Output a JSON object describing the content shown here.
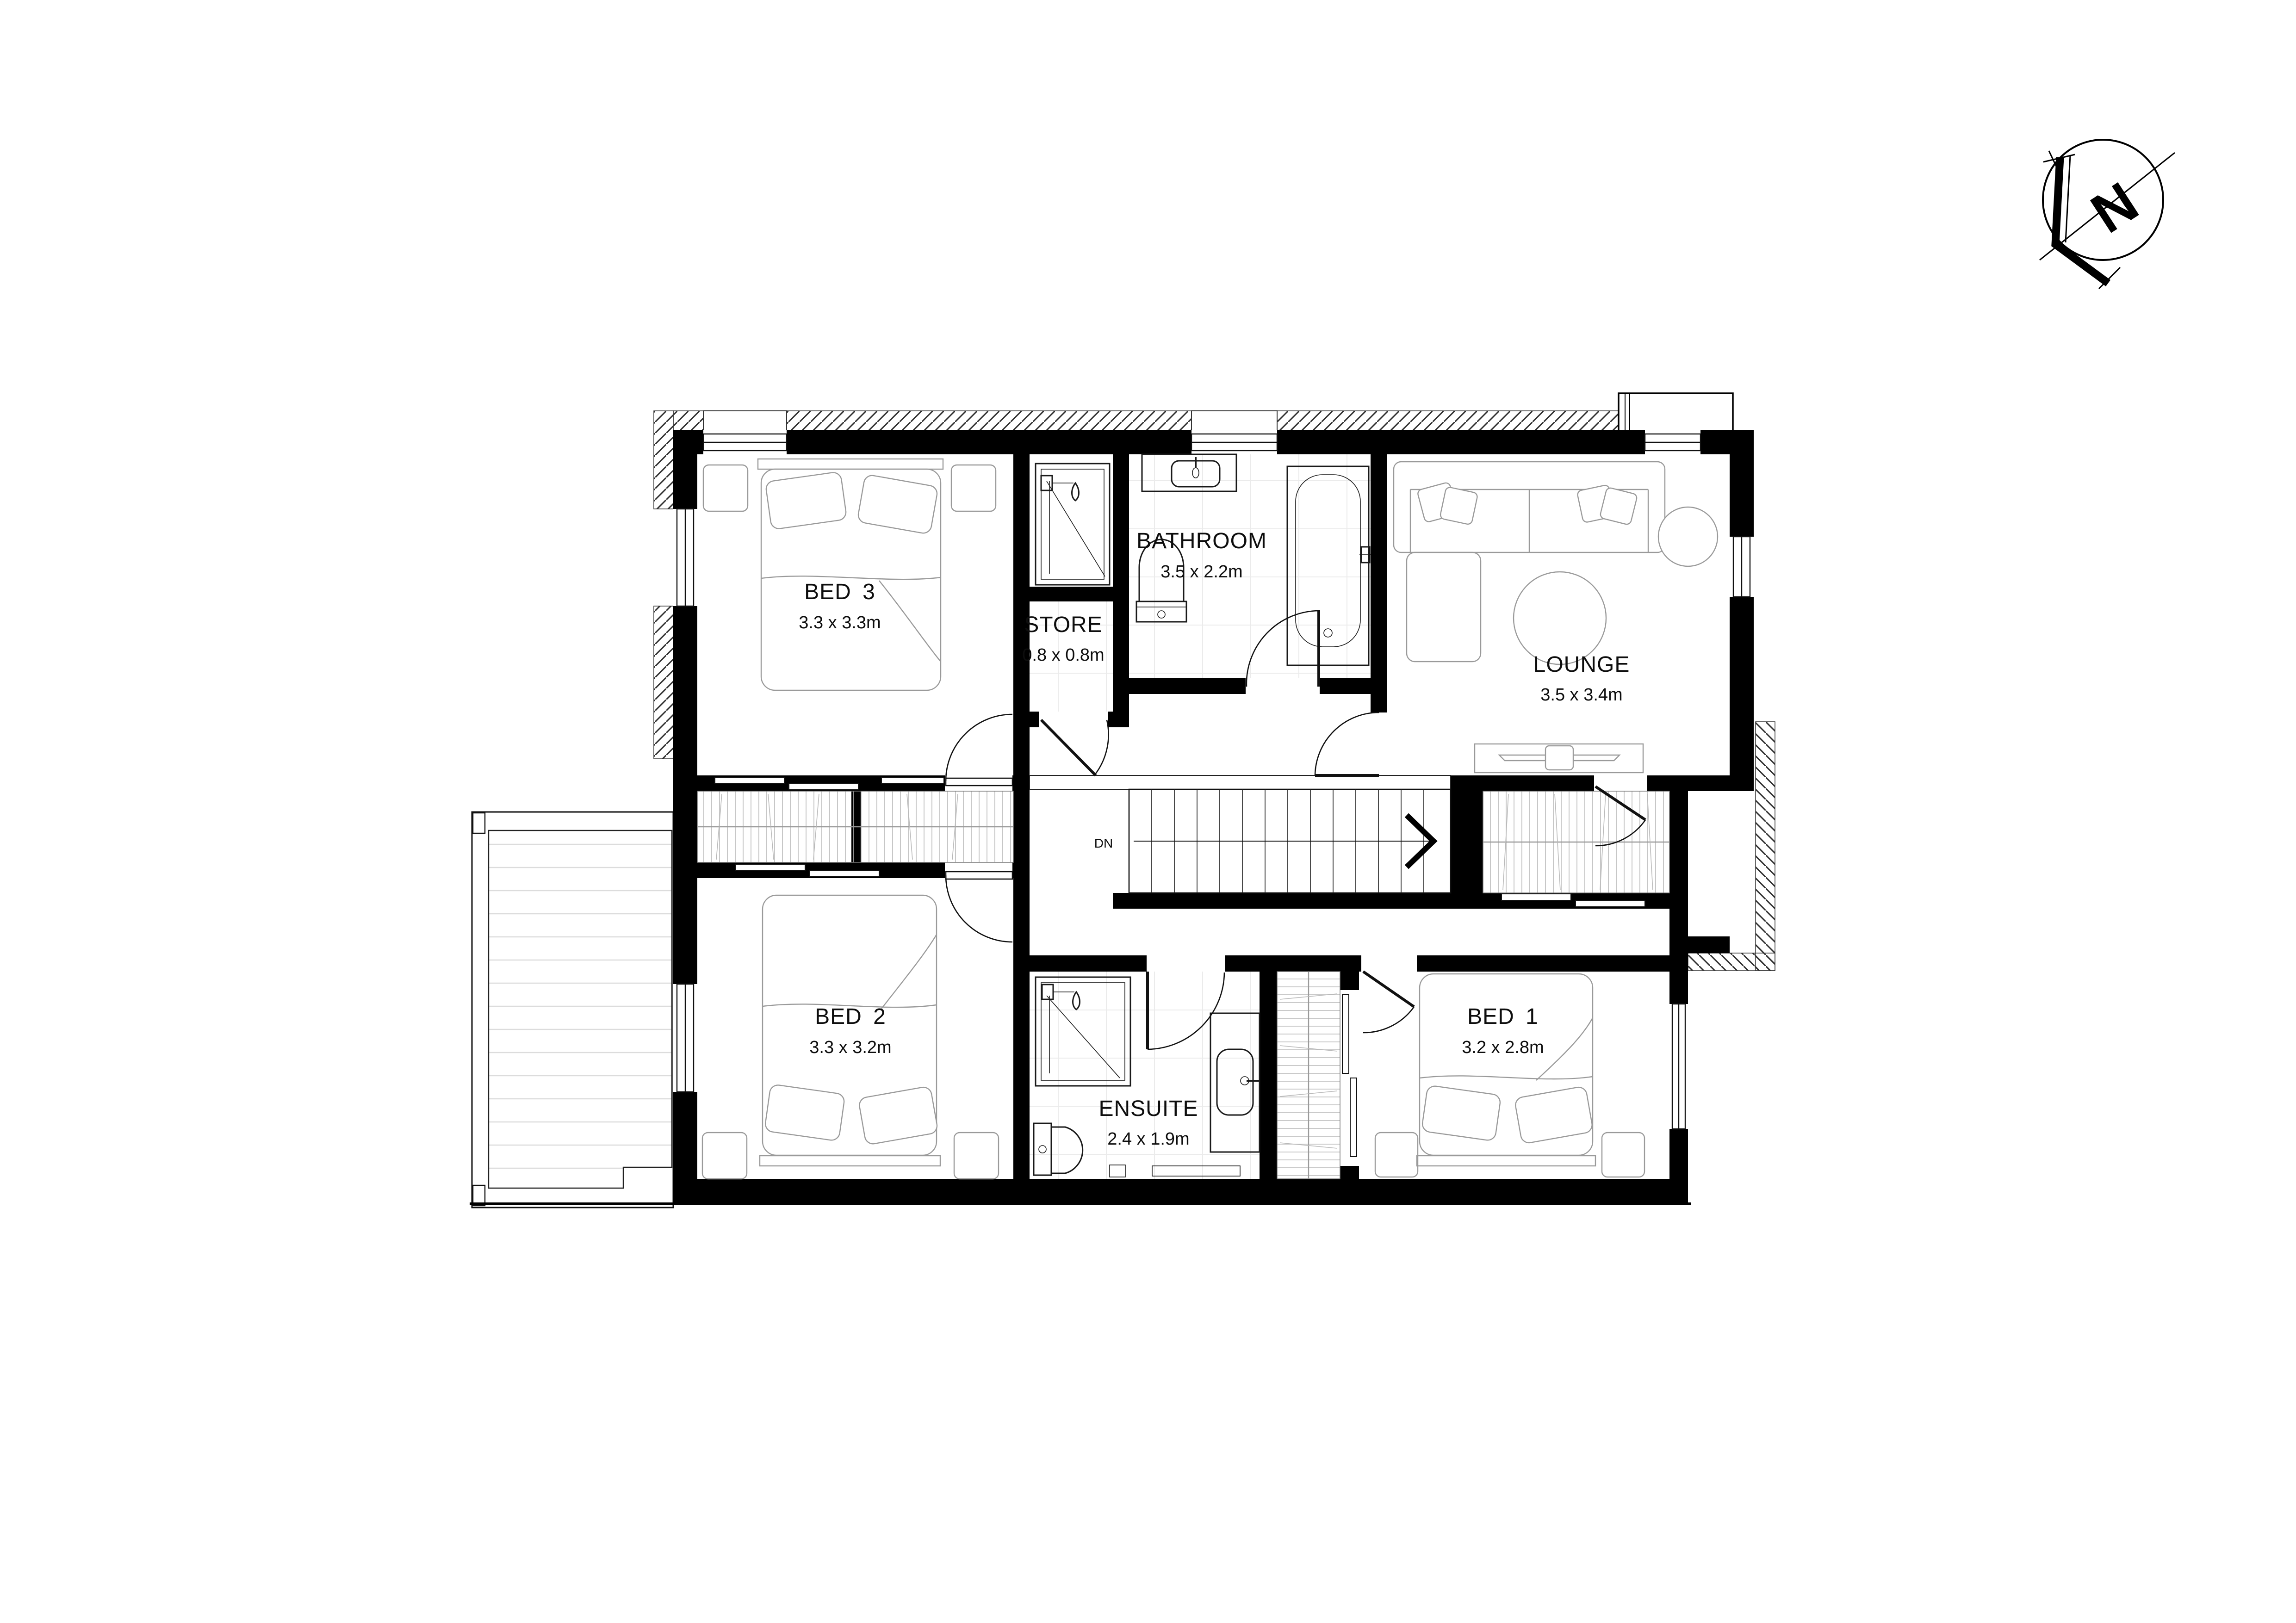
{
  "floor_plan": {
    "rooms": [
      {
        "name": "BED 3",
        "dims": "3.3 x 3.3m"
      },
      {
        "name": "STORE",
        "dims": "0.8 x 0.8m"
      },
      {
        "name": "BATHROOM",
        "dims": "3.5 x 2.2m"
      },
      {
        "name": "LOUNGE",
        "dims": "3.5 x 3.4m"
      },
      {
        "name": "BED 2",
        "dims": "3.3 x 3.2m"
      },
      {
        "name": "ENSUITE",
        "dims": "2.4 x 1.9m"
      },
      {
        "name": "BED 1",
        "dims": "3.2 x 2.8m"
      }
    ],
    "stairs": {
      "label": "DN"
    },
    "compass": {
      "label": "N"
    },
    "colors": {
      "wall": "#000000",
      "fixture_line": "#1a1a1a",
      "furniture_line": "#9a9a9a",
      "hatch_line": "#2f2f2f",
      "tile_line": "#ebebeb",
      "deck_line": "#dcdcdc",
      "background": "#ffffff"
    }
  }
}
